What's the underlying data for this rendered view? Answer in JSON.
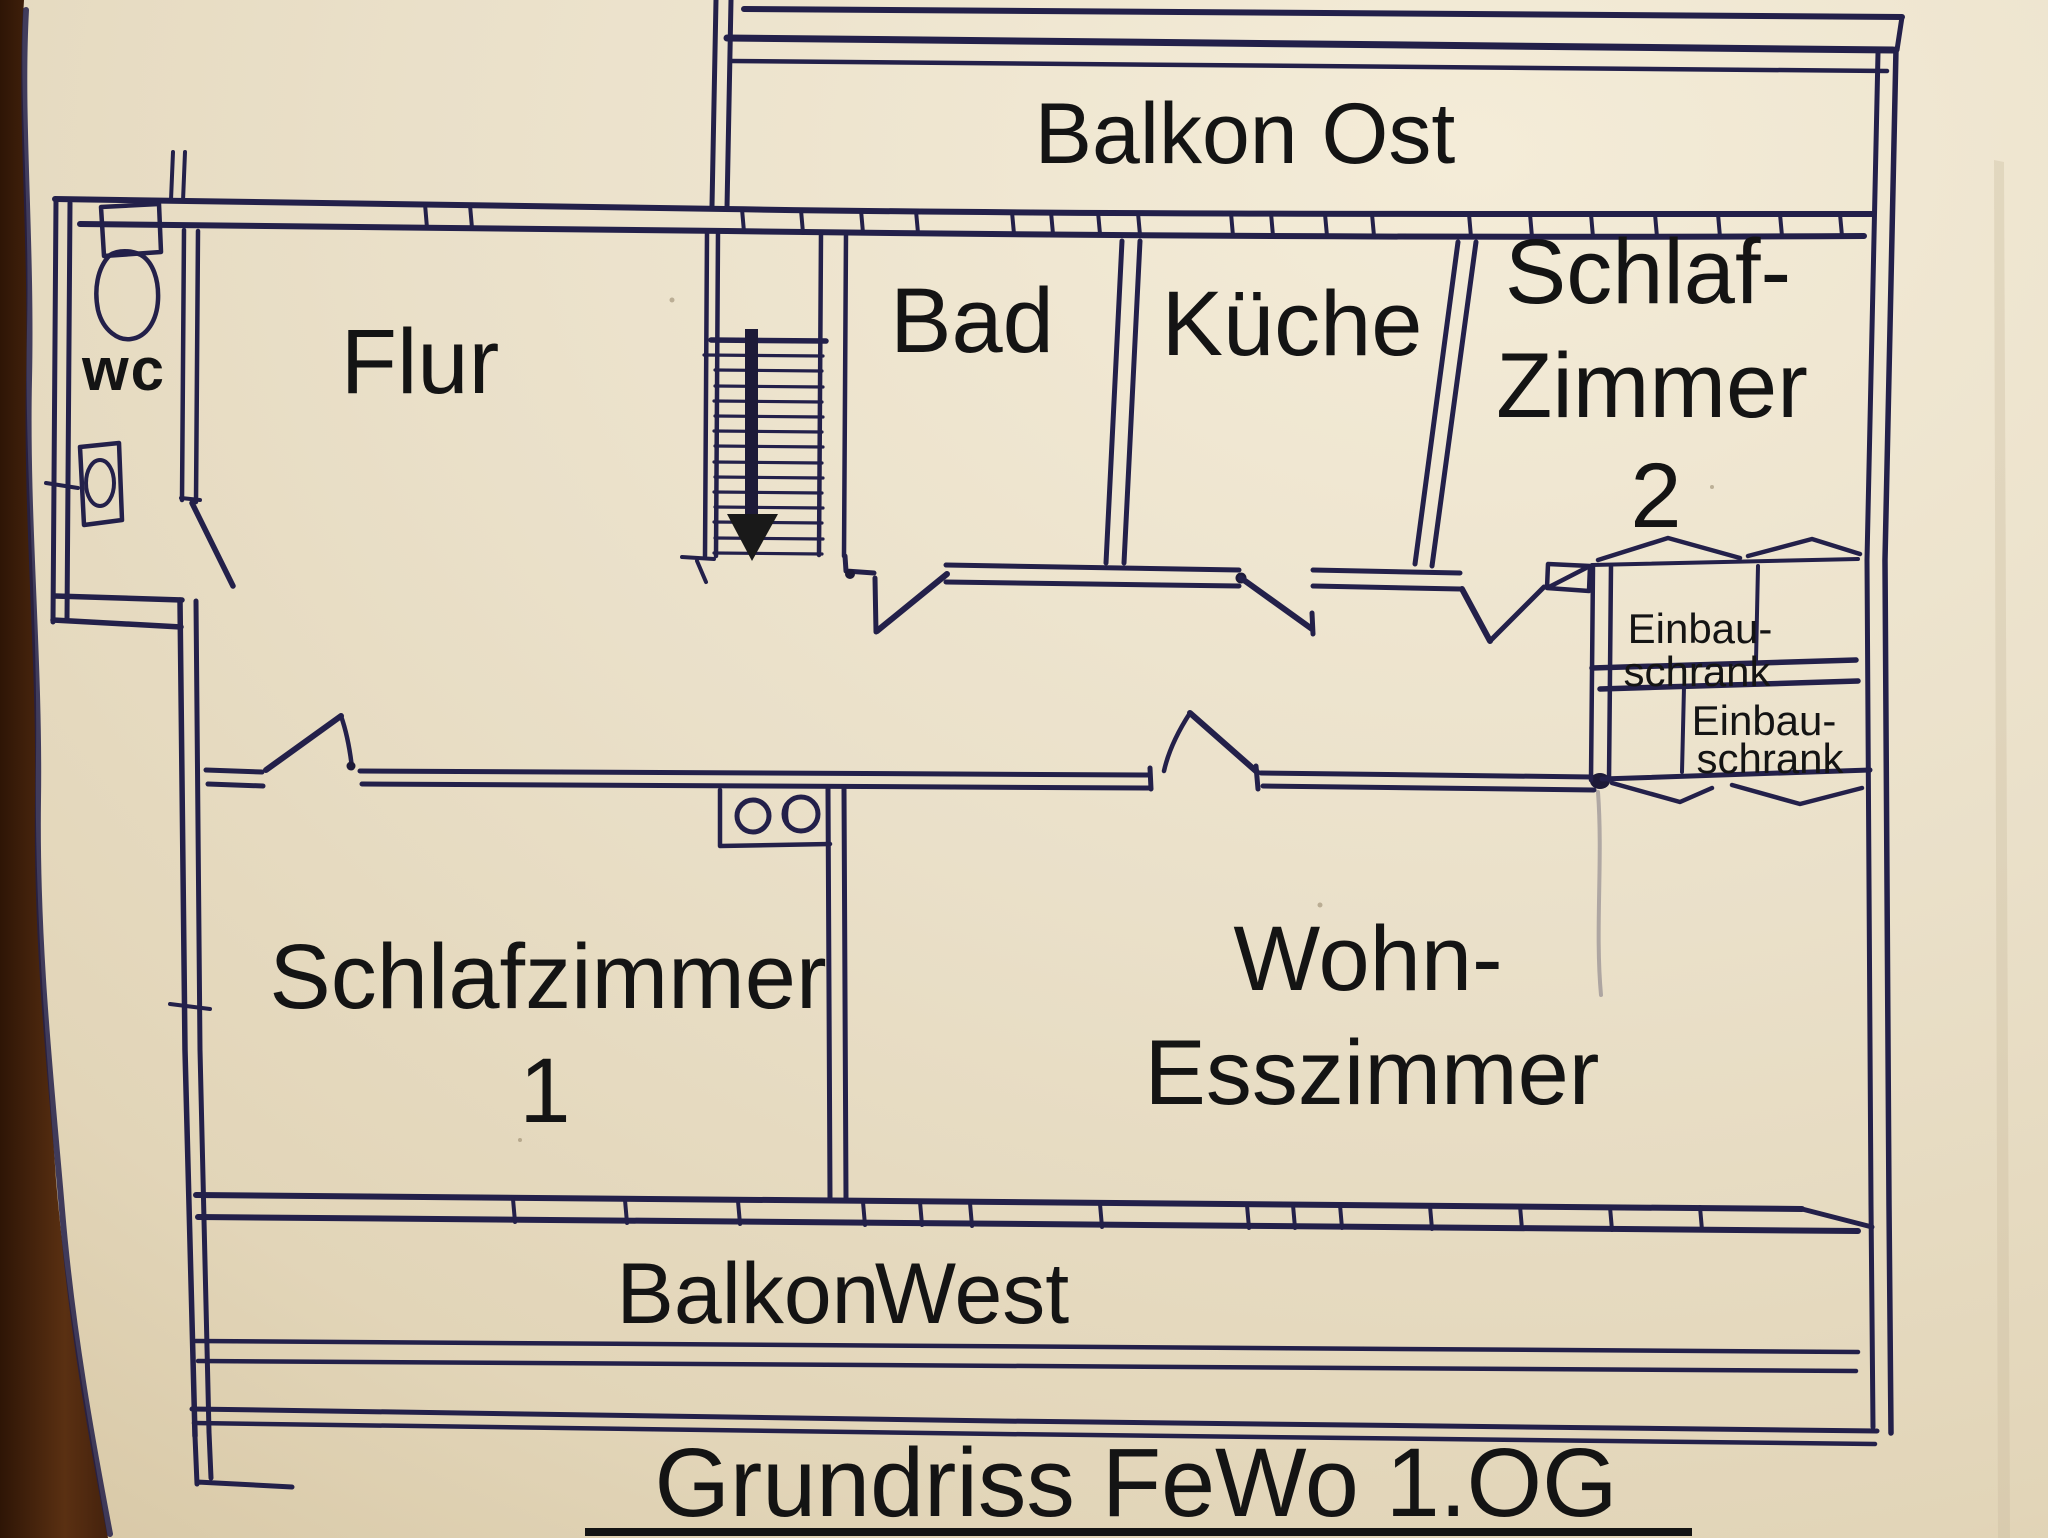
{
  "page": {
    "title_label": "Grundriss FeWo 1.OG"
  },
  "balconies": {
    "east_label": "Balkon Ost",
    "west_label_word1": "Balkon",
    "west_label_word2": "West"
  },
  "rooms": {
    "wc_label": "wc",
    "flur_label": "Flur",
    "bad_label": "Bad",
    "kueche_label": "Küche",
    "schlafzimmer2_line1": "Schlaf-",
    "schlafzimmer2_line2": "Zimmer",
    "schlafzimmer2_line3": "2",
    "schlafzimmer1_line1": "Schlafzimmer",
    "schlafzimmer1_line2": "1",
    "wohn_esszimmer_line1": "Wohn-",
    "wohn_esszimmer_line2": "Esszimmer"
  },
  "closets": {
    "einbauschrank_top_line1": "Einbau-",
    "einbauschrank_top_line2": "schrank",
    "einbauschrank_bottom_line1": "Einbau-",
    "einbauschrank_bottom_line2": "schrank"
  },
  "icons": {
    "stairs_arrow": "down-arrow",
    "toilet": "toilet-top-view",
    "sink": "washbasin-top-view",
    "double_basin": "double-washbasin-top-view"
  },
  "colors": {
    "paper": "#e9dfc8",
    "ink": "#23204a",
    "label_text": "#141414",
    "wood_edge": "#45220d"
  }
}
